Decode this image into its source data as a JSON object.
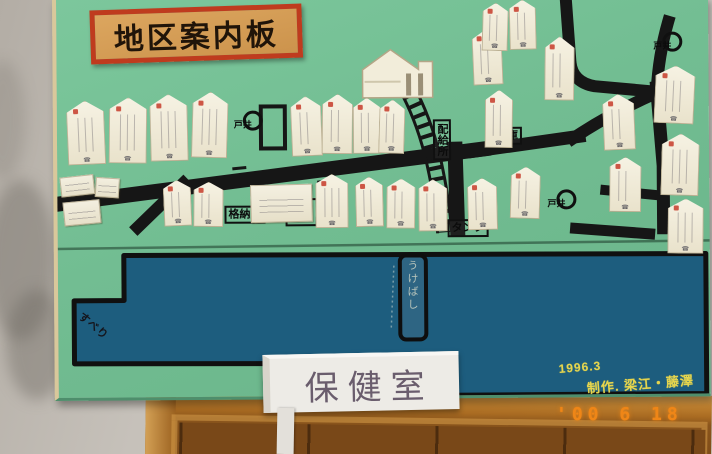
{
  "board": {
    "title": "地区案内板",
    "well_label": "井戸",
    "phone_mark": "☎",
    "boxed_labels": [
      {
        "text": "配給所",
        "x": 376,
        "y": 122,
        "style": "vertical"
      },
      {
        "text": "倉庫",
        "x": 435,
        "y": 130,
        "style": "h"
      },
      {
        "text": "格納庫",
        "x": 167,
        "y": 207,
        "style": "h"
      },
      {
        "text": "消防小屋",
        "x": 228,
        "y": 200,
        "style": "square"
      },
      {
        "text": "タンク",
        "x": 390,
        "y": 222,
        "style": "h"
      }
    ],
    "wells": [
      {
        "x": 186,
        "y": 112
      },
      {
        "x": 499,
        "y": 193
      },
      {
        "x": 606,
        "y": 36
      }
    ],
    "houses": [
      {
        "x": 10,
        "y": 101,
        "w": 38,
        "h": 64,
        "r": -2
      },
      {
        "x": 52,
        "y": 98,
        "w": 38,
        "h": 66,
        "r": 1
      },
      {
        "x": 93,
        "y": 95,
        "w": 38,
        "h": 67,
        "r": -1
      },
      {
        "x": 135,
        "y": 93,
        "w": 36,
        "h": 66,
        "r": 2
      },
      {
        "x": 234,
        "y": 98,
        "w": 31,
        "h": 60,
        "r": -2
      },
      {
        "x": 265,
        "y": 96,
        "w": 31,
        "h": 60,
        "r": 1
      },
      {
        "x": 296,
        "y": 100,
        "w": 28,
        "h": 56,
        "r": 0
      },
      {
        "x": 322,
        "y": 102,
        "w": 26,
        "h": 54,
        "r": 2
      },
      {
        "x": 416,
        "y": 32,
        "w": 30,
        "h": 56,
        "r": -2
      },
      {
        "x": 428,
        "y": 93,
        "w": 28,
        "h": 58,
        "r": 1
      },
      {
        "x": 426,
        "y": 6,
        "w": 26,
        "h": 48,
        "r": 2
      },
      {
        "x": 453,
        "y": 3,
        "w": 27,
        "h": 50,
        "r": -1
      },
      {
        "x": 488,
        "y": 40,
        "w": 30,
        "h": 64,
        "r": 1
      },
      {
        "x": 546,
        "y": 98,
        "w": 32,
        "h": 56,
        "r": -2
      },
      {
        "x": 552,
        "y": 161,
        "w": 32,
        "h": 55,
        "r": 1
      },
      {
        "x": 598,
        "y": 70,
        "w": 40,
        "h": 58,
        "r": 3
      },
      {
        "x": 604,
        "y": 138,
        "w": 38,
        "h": 62,
        "r": 2
      },
      {
        "x": 610,
        "y": 203,
        "w": 36,
        "h": 55,
        "r": 1
      },
      {
        "x": 106,
        "y": 181,
        "w": 28,
        "h": 46,
        "r": -2
      },
      {
        "x": 136,
        "y": 183,
        "w": 30,
        "h": 45,
        "r": 1
      },
      {
        "x": 258,
        "y": 176,
        "w": 33,
        "h": 54,
        "r": 0
      },
      {
        "x": 298,
        "y": 179,
        "w": 28,
        "h": 50,
        "r": -1
      },
      {
        "x": 329,
        "y": 181,
        "w": 29,
        "h": 50,
        "r": 1
      },
      {
        "x": 361,
        "y": 182,
        "w": 29,
        "h": 52,
        "r": 0
      },
      {
        "x": 410,
        "y": 181,
        "w": 30,
        "h": 52,
        "r": -1
      },
      {
        "x": 453,
        "y": 170,
        "w": 30,
        "h": 52,
        "r": 2
      }
    ],
    "plates": [
      {
        "x": 3,
        "y": 176,
        "w": 34,
        "h": 20,
        "r": -6
      },
      {
        "x": 38,
        "y": 178,
        "w": 24,
        "h": 20,
        "r": 4
      },
      {
        "x": 6,
        "y": 201,
        "w": 37,
        "h": 24,
        "r": -5
      },
      {
        "x": 193,
        "y": 186,
        "w": 62,
        "h": 38,
        "r": -1
      }
    ],
    "river": {
      "slide_text": "すべり",
      "bridge_text": "うけばし"
    },
    "credit": {
      "line1": "1996.3",
      "line2": "制作. 梁江・藤澤"
    }
  },
  "health_sign": {
    "text": "保健室"
  },
  "date_stamp": {
    "text": "'00 6 18"
  }
}
